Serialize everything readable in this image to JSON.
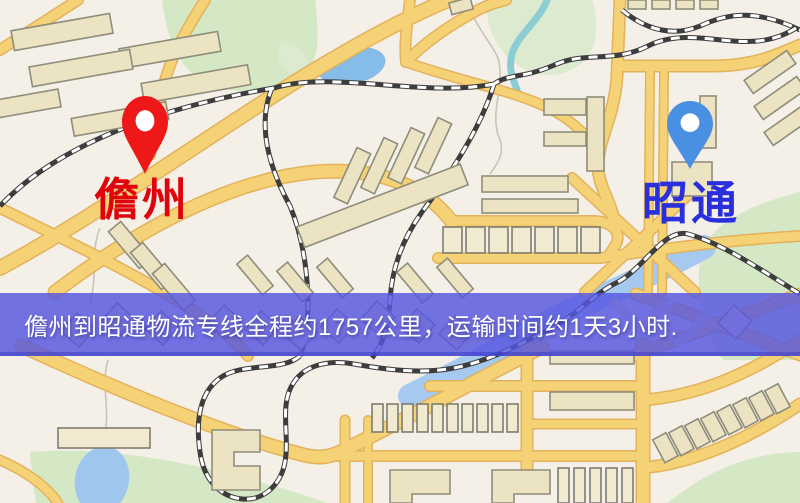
{
  "banner": {
    "text": "儋州到昭通物流专线全程约1757公里，运输时间约1天3小时.",
    "origin": "儋州",
    "destination": "昭通",
    "distance": "约1757公里",
    "duration": "约1天3小时",
    "background_color": "#5656e1",
    "text_color": "#ffffff"
  },
  "markers": {
    "origin": {
      "label": "儋州",
      "pin_color": "#ee1818",
      "label_color": "#df040c"
    },
    "destination": {
      "label": "昭通",
      "pin_color": "#4a90e2",
      "label_color": "#2a2fdd"
    }
  },
  "map": {
    "colors": {
      "background": "#f4efe7",
      "road_fill": "#f6d277",
      "road_casing": "#e3b25a",
      "park": "#d5e8c6",
      "lake": "#85bce8",
      "river": "#a6c9ef",
      "stream": "#8ccdd4",
      "building": "#ece3c3",
      "railway": "#3d3d3d"
    }
  }
}
